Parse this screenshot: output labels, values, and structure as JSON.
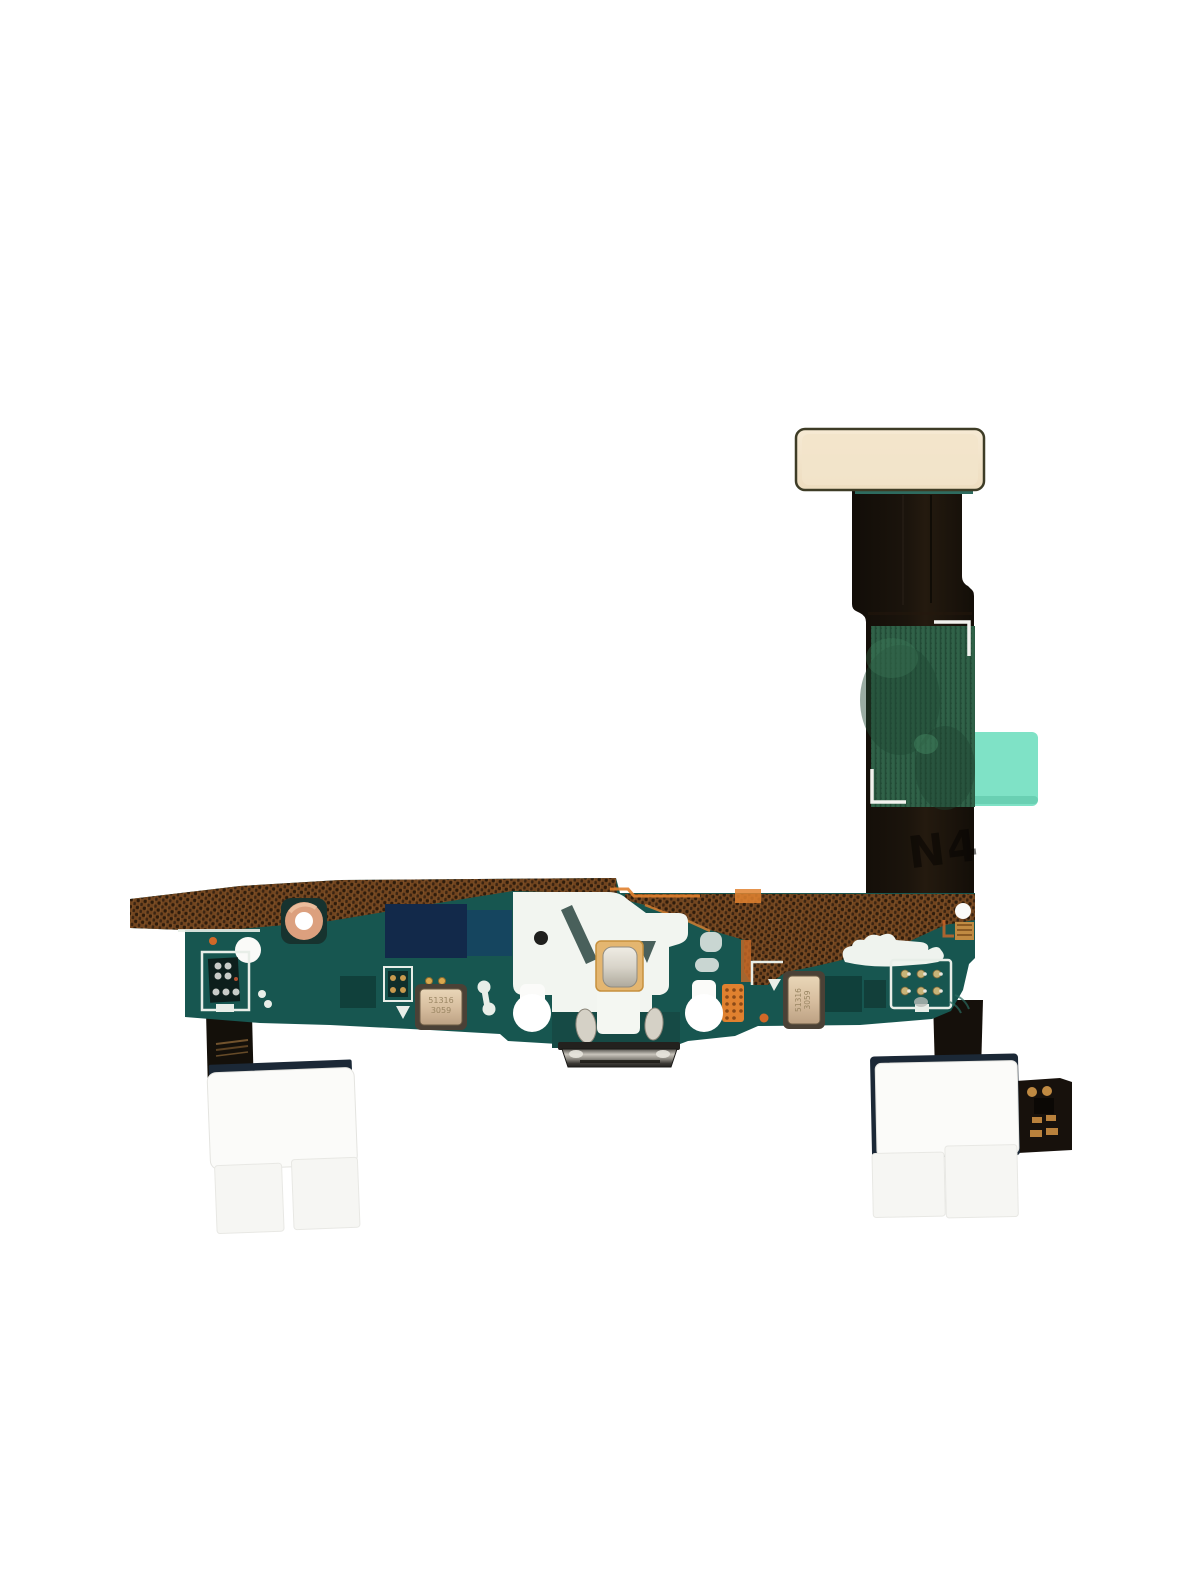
{
  "scene": {
    "type": "product-photo",
    "subject": "Charging port micro-USB flex cable assembly (smartphone replacement part) on white background"
  },
  "markings": {
    "ribbon_embossed": "N4",
    "mic_left_line1": "51316",
    "mic_left_line2": "3059",
    "mic_right_line1": "51316",
    "mic_right_line2": "3059"
  },
  "colors": {
    "background": "#FFFFFF",
    "pcb_teal": "#175650",
    "pcb_teal_dark": "#10403B",
    "copper_mesh": "#72451F",
    "copper_mesh_dot": "#2E1C0C",
    "connector_cream": "#F2E4CA",
    "ribbon_black": "#16110B",
    "sticker_green": "#2C5C44",
    "tab_mint": "#7FE2C6",
    "sticker_white": "#FBFBF9",
    "pad_gold": "#E4B670",
    "mic_gold": "#D8BFA0",
    "accent_orange": "#E0812F",
    "silver": "#D6D2C8",
    "navy_patch": "#12294A",
    "grommet_copper": "#DCA07E"
  }
}
